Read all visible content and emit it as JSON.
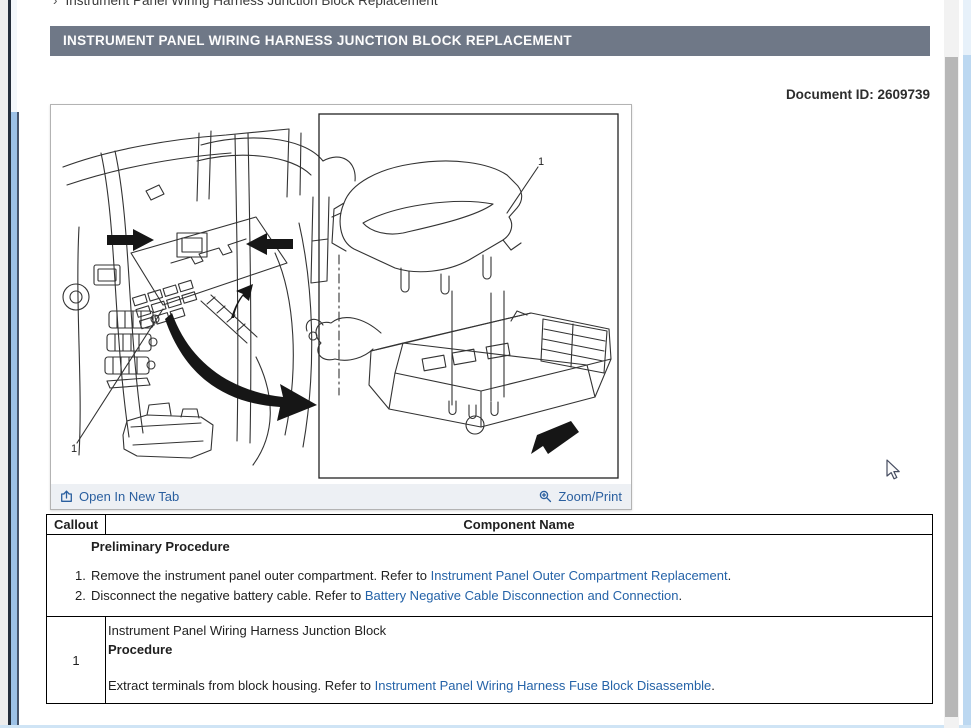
{
  "colors": {
    "title_bar_bg": "#6f7887",
    "title_bar_text": "#ffffff",
    "link": "#2563a8",
    "body_text": "#1f1f1f",
    "table_border": "#000000",
    "figure_toolbar_bg": "#edf0f4",
    "figure_border": "#b3b3b3",
    "left_blue_strip": "#9cc1e6",
    "right_blue_strip": "#bcd8f1",
    "scrollbar_thumb": "#b7b7b7"
  },
  "page": {
    "breadcrumb_chevron": "›",
    "breadcrumb": "Instrument Panel Wiring Harness Junction Block Replacement",
    "title": "INSTRUMENT PANEL WIRING HARNESS JUNCTION BLOCK REPLACEMENT",
    "document_id": "Document ID: 2609739"
  },
  "figure": {
    "open_in_new_tab_label": "Open In New Tab",
    "zoom_print_label": "Zoom/Print",
    "left_callout": "1",
    "right_callout": "1"
  },
  "table": {
    "headers": [
      "Callout",
      "Component Name"
    ],
    "preliminary": {
      "title": "Preliminary Procedure",
      "steps": [
        {
          "num": "1.",
          "text": "Remove the instrument panel outer compartment. Refer to ",
          "link": "Instrument Panel Outer Compartment Replacement",
          "suffix": "."
        },
        {
          "num": "2.",
          "text": "Disconnect the negative battery cable. Refer to ",
          "link": "Battery Negative Cable Disconnection and Connection",
          "suffix": "."
        }
      ]
    },
    "rows": [
      {
        "callout": "1",
        "component": "Instrument Panel Wiring Harness Junction Block",
        "procedure_label": "Procedure",
        "step_text": "Extract terminals from block housing. Refer to ",
        "step_link": "Instrument Panel Wiring Harness Fuse Block Disassemble",
        "step_suffix": "."
      }
    ]
  }
}
